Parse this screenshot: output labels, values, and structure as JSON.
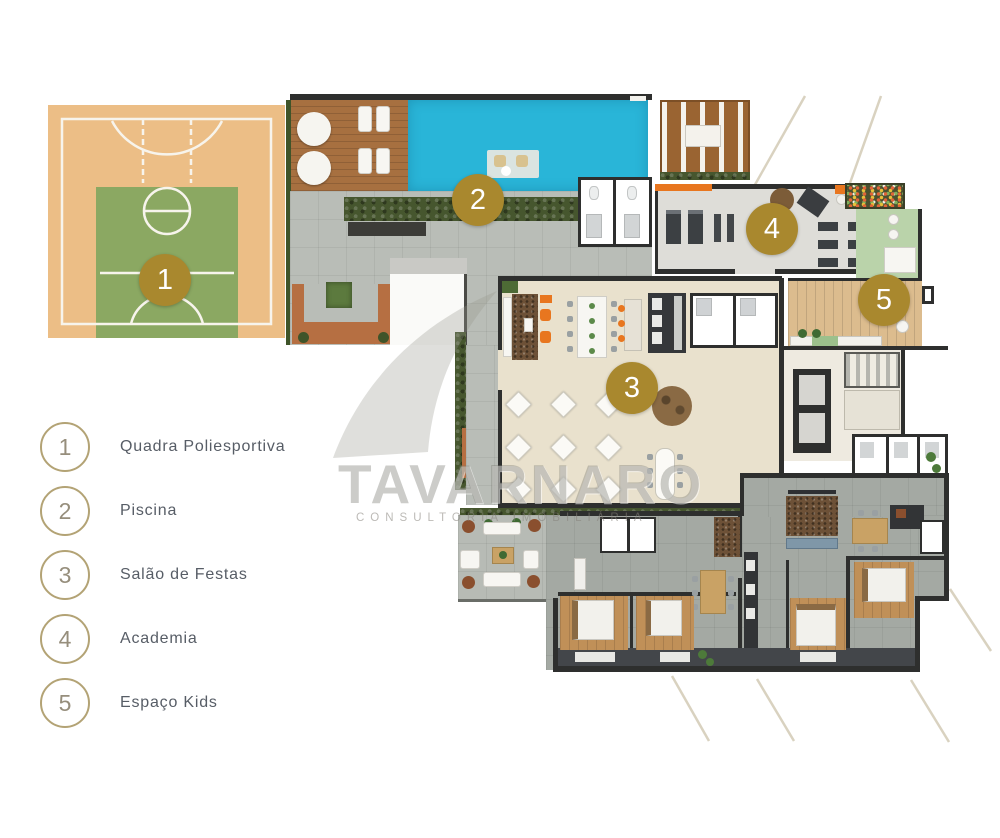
{
  "watermark": {
    "brand": "TAVARNARO",
    "tagline": "CONSULTORIA IMOBILIÁRIA"
  },
  "legend": {
    "items": [
      {
        "number": "1",
        "label": "Quadra Poliesportiva"
      },
      {
        "number": "2",
        "label": "Piscina"
      },
      {
        "number": "3",
        "label": "Salão de Festas"
      },
      {
        "number": "4",
        "label": "Academia"
      },
      {
        "number": "5",
        "label": "Espaço Kids"
      }
    ]
  },
  "plan_badges": [
    {
      "number": "1",
      "area": "Quadra Poliesportiva"
    },
    {
      "number": "2",
      "area": "Piscina"
    },
    {
      "number": "3",
      "area": "Salão de Festas"
    },
    {
      "number": "4",
      "area": "Academia"
    },
    {
      "number": "5",
      "area": "Espaço Kids"
    }
  ],
  "colors": {
    "badge_gold": "#a9882e",
    "legend_circle": "#b3a375",
    "pool_water": "#29b5d8",
    "court_floor": "#ecbe86",
    "court_green": "#8ba862",
    "kids_green": "#bad3aa",
    "gym_orange": "#e8761f",
    "wood_deck": "#a77040",
    "party_floor": "#e9e1cd",
    "apartment_floor": "#a4a9a3",
    "wall": "#2e2f2e"
  }
}
